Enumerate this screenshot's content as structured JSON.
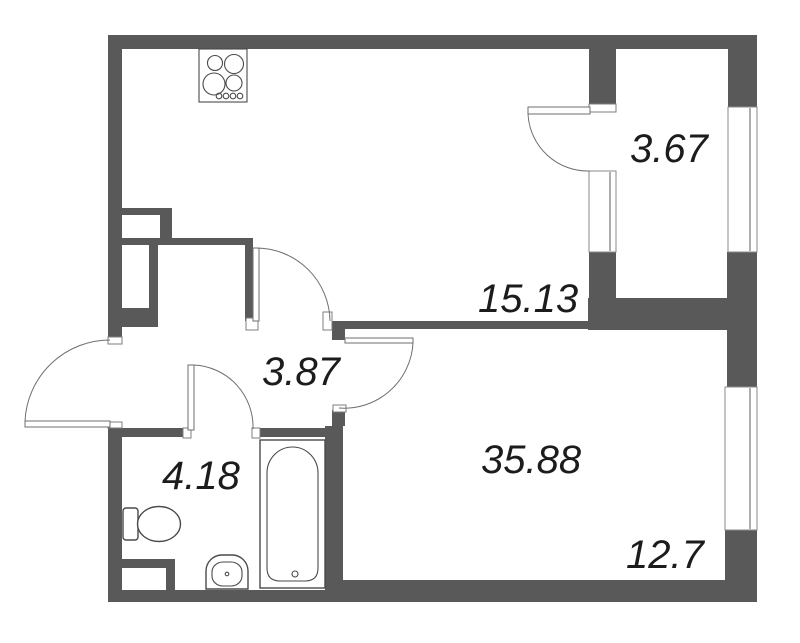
{
  "colors": {
    "wall": "#595959",
    "line": "#6e6e6e",
    "text": "#1c1c1c",
    "bg": "#ffffff"
  },
  "rooms": [
    {
      "id": "kitchen-living",
      "area": "15.13"
    },
    {
      "id": "balcony-top",
      "area": "3.67"
    },
    {
      "id": "hallway",
      "area": "3.87"
    },
    {
      "id": "bathroom",
      "area": "4.18"
    },
    {
      "id": "main-room",
      "area": "35.88"
    },
    {
      "id": "loggia-bottom",
      "area": "12.7"
    }
  ],
  "fixtures": {
    "stove": "stove-icon",
    "toilet": "toilet-icon",
    "sink": "sink-icon",
    "bathtub": "bathtub-icon"
  }
}
